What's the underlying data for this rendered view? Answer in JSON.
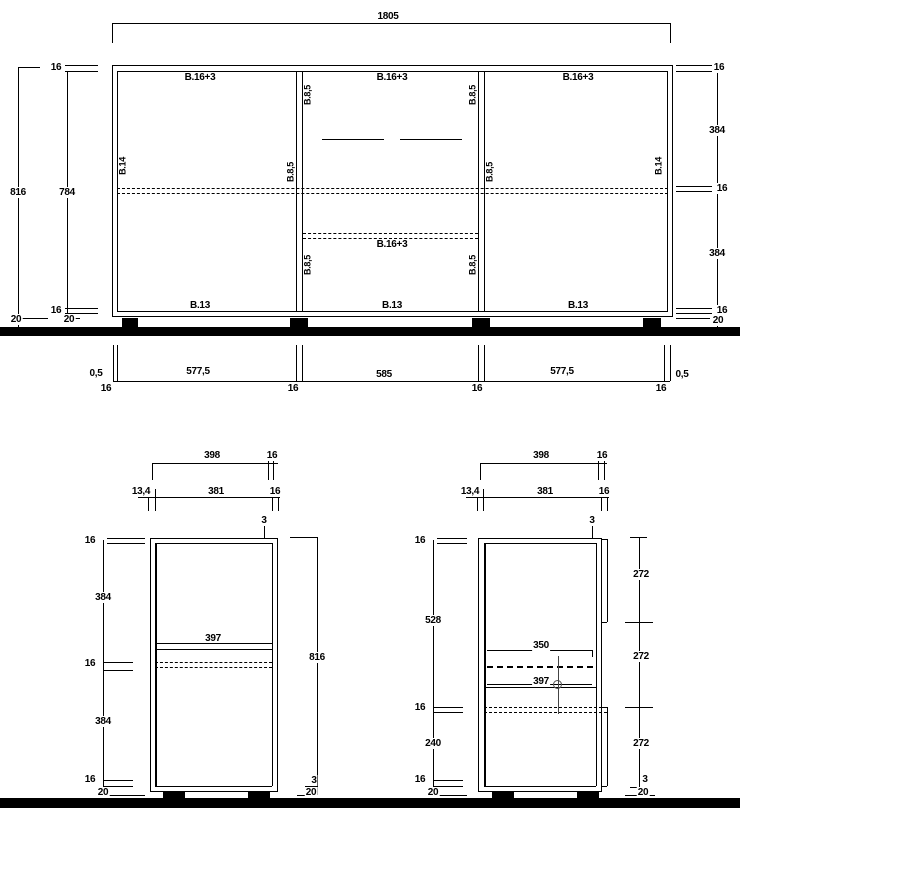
{
  "dimensions": {
    "overall_width": "1805",
    "overall_height": "816",
    "interior_height": "784",
    "panel_thickness": "16",
    "plinth_height": "20",
    "opening_height": "384",
    "reveal_gap": "0,5",
    "side_bay_width": "577,5",
    "center_bay_width": "585",
    "side_depth": "398",
    "back_inset": "13,4",
    "interior_depth": "381",
    "front_gap": "3",
    "shelf_depth": "397",
    "upper_opening": "528",
    "lower_opening": "240",
    "front_height": "272",
    "drawer_depth": "350"
  },
  "board_labels": {
    "top_bottom_panel": "B.16+3",
    "base_panel": "B.13",
    "side_panel": "B.14",
    "divider_panel": "B.8,5"
  }
}
